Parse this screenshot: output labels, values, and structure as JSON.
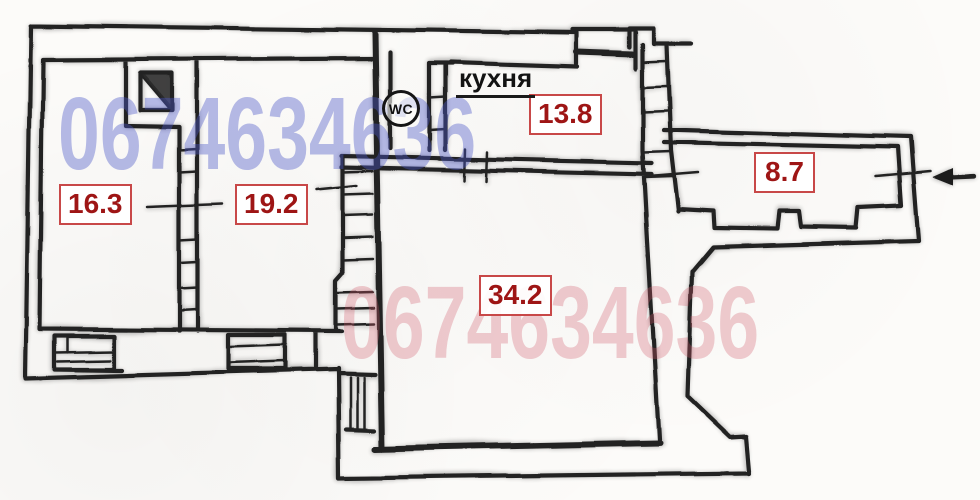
{
  "plan": {
    "area_labels": {
      "room_left": "16.3",
      "room_middle": "19.2",
      "room_large": "34.2",
      "kitchen": "13.8",
      "hallway": "8.7"
    },
    "kitchen_title": "кухня",
    "wc_label": "WC"
  },
  "watermarks": {
    "top_left": "0674634636",
    "bottom_right": "0674634636"
  },
  "colors": {
    "wall_ink": "#242424",
    "area_label_text": "#9e1515",
    "area_label_border": "#c84848",
    "watermark_blue": "#4a58c8",
    "watermark_pink": "#d05a6a"
  }
}
